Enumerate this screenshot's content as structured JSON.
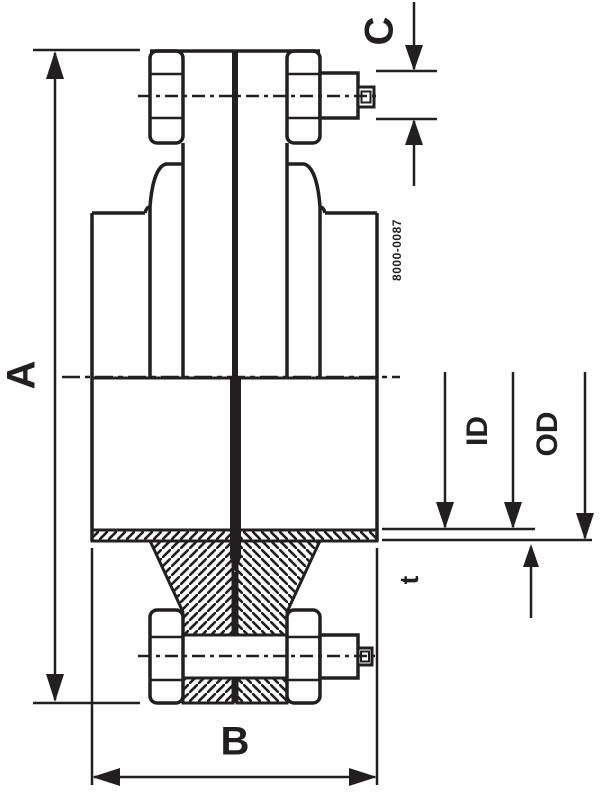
{
  "drawing": {
    "title_hint": "flange-union-cross-section",
    "dimension_labels": {
      "overall_height": "A",
      "overall_width": "B",
      "bolt_extension": "C",
      "inner_diameter": "ID",
      "outer_diameter": "OD",
      "wall_thickness": "t"
    },
    "part_number": "8000-0087",
    "colors": {
      "ink": "#231f20",
      "background": "#ffffff"
    }
  }
}
